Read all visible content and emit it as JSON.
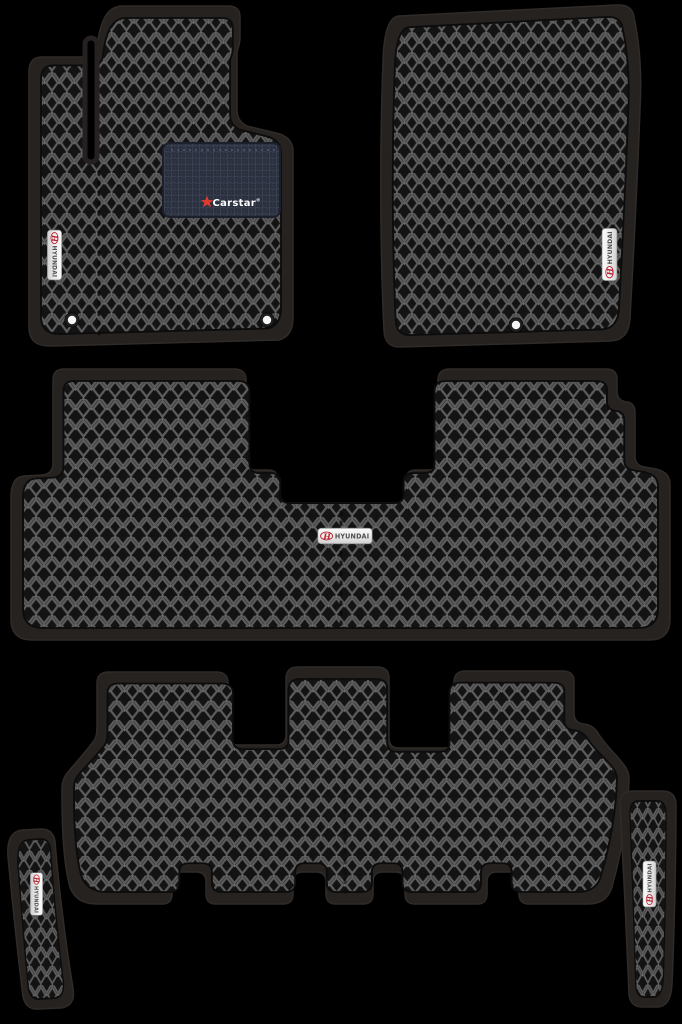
{
  "set": {
    "piece_count": "6",
    "badge_count": "5"
  },
  "badge": {
    "brand_text": "HYUNDAI",
    "logo_letter": "H"
  },
  "heel_pad": {
    "brand_text": "Carstar",
    "registered_mark": "®"
  },
  "colors": {
    "background": "#000000",
    "mat_border": "#262220",
    "mat_base": "#131313",
    "pattern_line": "#5d5d5d",
    "badge_background": "#f2f2f2",
    "badge_text": "#4d4d4d",
    "hyundai_red": "#b8222e",
    "heel_pad_background": "#2a2f3d",
    "carstar_red": "#e03a2f",
    "carstar_text": "#ffffff",
    "fixing_hole": "#f5f5f5"
  }
}
